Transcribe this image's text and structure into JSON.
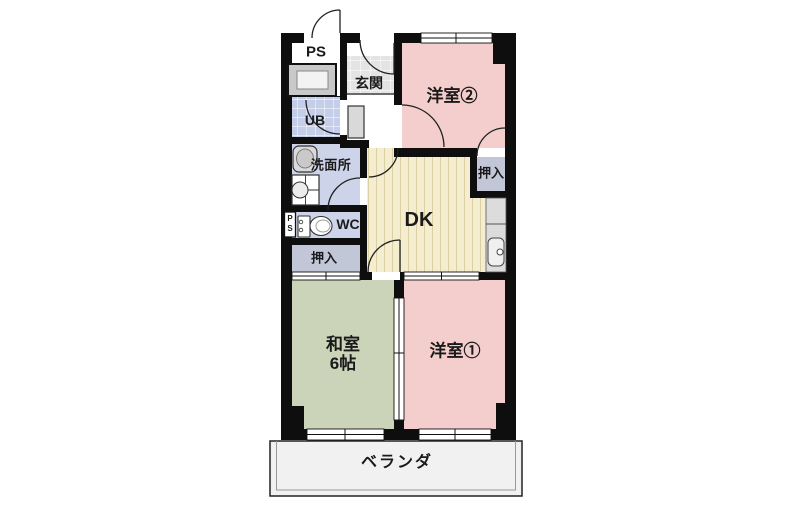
{
  "colors": {
    "wall": "#0e0e0e",
    "room_pink": "#f3cecd",
    "room_green": "#cbd3b9",
    "dk_bg": "#f4edcf",
    "dk_stripe": "#dccfa2",
    "lavender": "#cdd3e8",
    "closet": "#c2c7d8",
    "tile_bg": "#e4e4e4",
    "tile_line": "#ffffff",
    "ub_bg": "#c5cee9",
    "balcony_bg": "#f1f1f1",
    "counter": "#dcdcdc",
    "fixture": "#d9d9d9"
  },
  "floorplan": {
    "rooms": {
      "ps_top": {
        "label": "PS"
      },
      "genkan": {
        "label": "玄関"
      },
      "yoshitsu2": {
        "label": "洋室②"
      },
      "ub": {
        "label": "UB"
      },
      "senmenjo": {
        "label": "洗面所"
      },
      "wc": {
        "label": "WC"
      },
      "ps_shaft": {
        "label": "PS"
      },
      "oshiire_hall": {
        "label": "押入"
      },
      "oshiire_yoshitsu2": {
        "label": "押入"
      },
      "dk": {
        "label": "DK"
      },
      "washitsu": {
        "label": "和室",
        "size": "6帖"
      },
      "yoshitsu1": {
        "label": "洋室①"
      },
      "veranda": {
        "label": "ベランダ"
      }
    }
  }
}
